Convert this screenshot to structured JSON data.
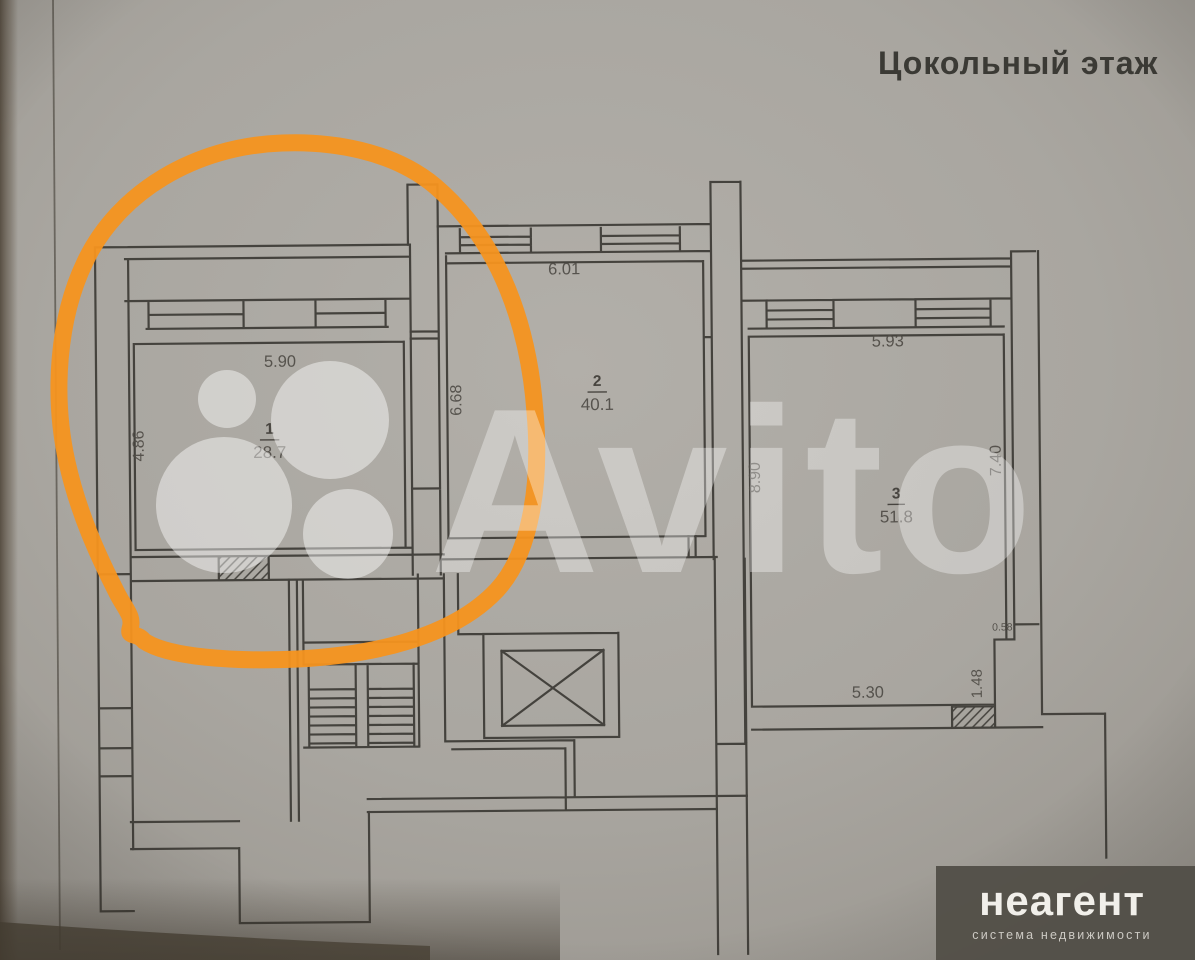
{
  "title": "Цокольный этаж",
  "rooms": [
    {
      "number": "1",
      "area": "28.7",
      "top_dim": "5.90",
      "side_dim": "4.86"
    },
    {
      "number": "2",
      "area": "40.1",
      "top_dim": "6.01",
      "side_dim": "6.68"
    },
    {
      "number": "3",
      "area": "51.8",
      "top_dim": "5.93",
      "side_dim": "8.90",
      "right_dim": "7.40",
      "bottom_dim": "5.30",
      "notch_dim": "1.48",
      "notch_dim_small": "0.58"
    }
  ],
  "watermark": {
    "text": "Avito"
  },
  "branding": {
    "name": "неагент",
    "tagline": "система недвижимости"
  },
  "annotation": {
    "shape": "hand-drawn-circle",
    "color": "#f5941f",
    "marks_room": "1"
  },
  "colors": {
    "paper": "#a9a6a0",
    "ink": "#3d3b36",
    "accent_orange": "#f5941f",
    "banner_bg": "#534f48"
  }
}
